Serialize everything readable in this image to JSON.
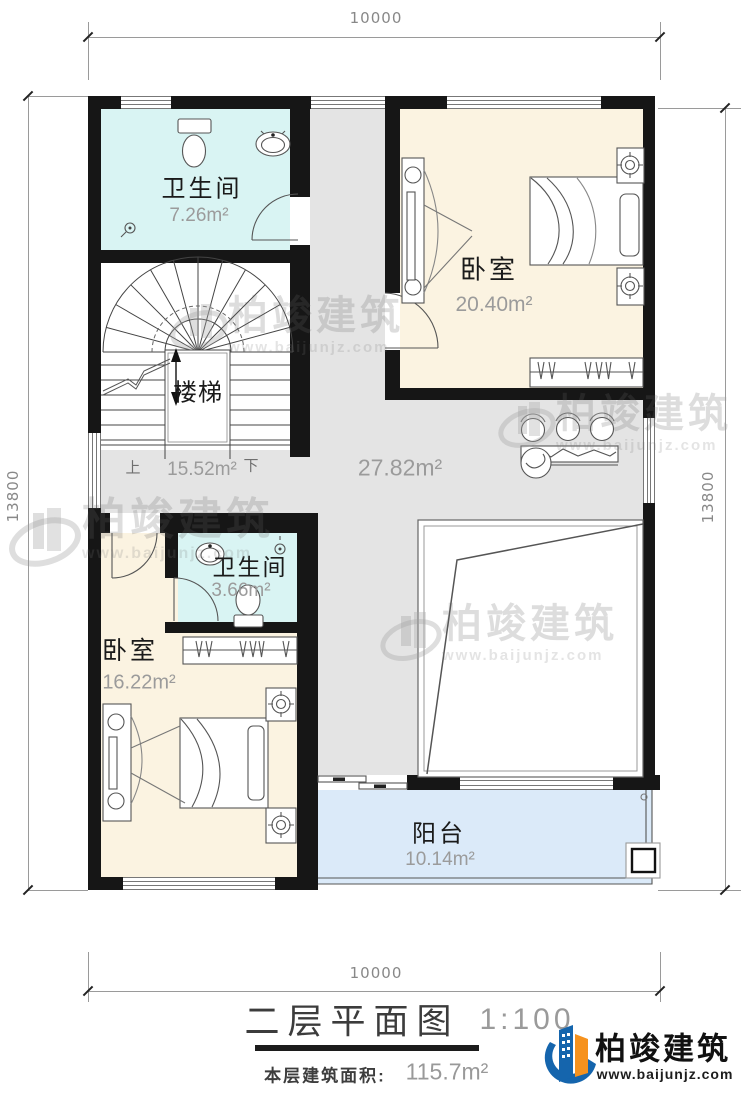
{
  "title": {
    "text": "二层平面图",
    "scale": "1:100",
    "floor_area_label": "本层建筑面积:",
    "floor_area_value": "115.7m²"
  },
  "brand": {
    "name": "柏竣建筑",
    "url": "www.baijunjz.com"
  },
  "watermark": {
    "name": "柏竣建筑",
    "url": "www.baijunjz.com"
  },
  "dims": {
    "top": "10000",
    "bottom": "10000",
    "left": "13800",
    "right": "13800"
  },
  "rooms": {
    "bathTop": {
      "name": "卫生间",
      "area": "7.26m²"
    },
    "bedroomTop": {
      "name": "卧室",
      "area": "20.40m²"
    },
    "stairs": {
      "name": "楼梯",
      "area": "15.52m²",
      "up": "上",
      "down": "下"
    },
    "hall": {
      "area": "27.82m²"
    },
    "bathSmall": {
      "name": "卫生间",
      "area": "3.66m²"
    },
    "bedroomBottom": {
      "name": "卧室",
      "area": "16.22m²"
    },
    "balcony": {
      "name": "阳台",
      "area": "10.14m²"
    }
  },
  "colors": {
    "wall": "#161616",
    "bathroom_fill": "#d9f4f3",
    "bedroom_fill": "#fbf3e1",
    "hall_fill": "#e4e4e4",
    "balcony_fill": "#dbeaf9",
    "brand_blue": "#1565ad",
    "brand_orange": "#f6921e"
  }
}
